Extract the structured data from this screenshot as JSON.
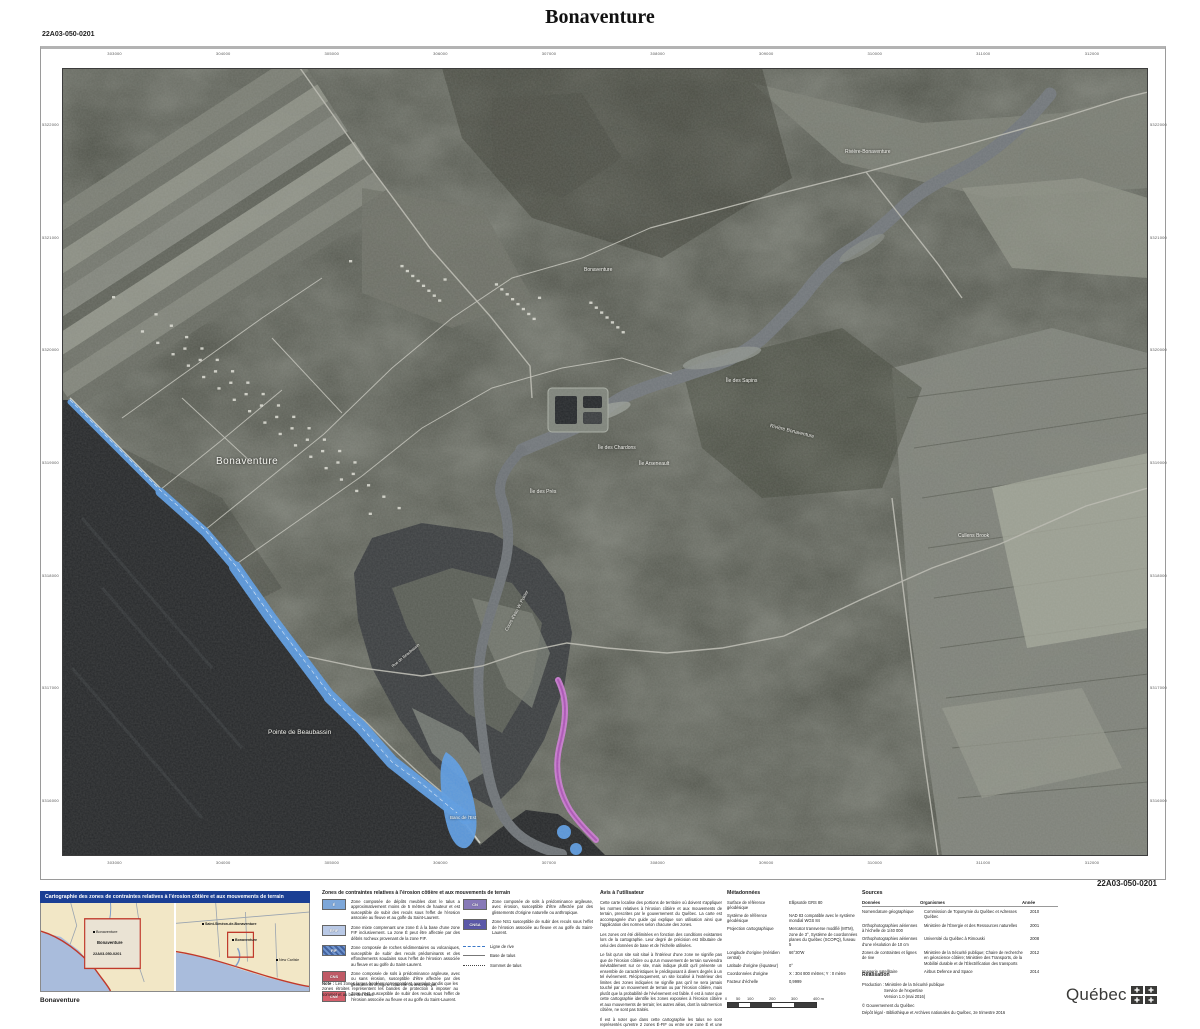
{
  "title": "Bonaventure",
  "sheet_code": "22A03-050-0201",
  "map": {
    "ticks_top": [
      "303000",
      "304000",
      "305000",
      "306000",
      "307000",
      "308000",
      "309000",
      "310000",
      "311000",
      "312000"
    ],
    "ticks_bottom": [
      "303000",
      "304000",
      "305000",
      "306000",
      "307000",
      "308000",
      "309000",
      "310000",
      "311000",
      "312000"
    ],
    "ticks_left": [
      "5322000",
      "5321000",
      "5320000",
      "5319000",
      "5318000",
      "5317000",
      "5316000"
    ],
    "ticks_right": [
      "5322000",
      "5321000",
      "5320000",
      "5319000",
      "5318000",
      "5317000",
      "5316000"
    ],
    "labels": [
      {
        "text": "Rivière-Bonaventure",
        "x": 783,
        "y": 81,
        "size": 5
      },
      {
        "text": "Bonaventure",
        "x": 522,
        "y": 199,
        "size": 5
      },
      {
        "text": "Île des Sapins",
        "x": 664,
        "y": 310,
        "size": 5
      },
      {
        "text": "Rivière Bonaventure",
        "x": 708,
        "y": 355,
        "size": 5,
        "rot": 14
      },
      {
        "text": "Île des Chardons",
        "x": 536,
        "y": 377,
        "size": 5
      },
      {
        "text": "Île Arseneault",
        "x": 577,
        "y": 393,
        "size": 5
      },
      {
        "text": "Île des Prés",
        "x": 468,
        "y": 421,
        "size": 5
      },
      {
        "text": "Bonaventure",
        "x": 154,
        "y": 388,
        "size": 10,
        "spacing": 0.5
      },
      {
        "text": "Cullens Brook",
        "x": 896,
        "y": 465,
        "size": 5
      },
      {
        "text": "Cours d'eau W. Poirier",
        "x": 444,
        "y": 560,
        "size": 4.5,
        "rot": -62
      },
      {
        "text": "Rue de Beaubassin",
        "x": 330,
        "y": 596,
        "size": 4,
        "rot": -40
      },
      {
        "text": "Pointe de Beaubassin",
        "x": 206,
        "y": 661,
        "size": 6.5
      },
      {
        "text": "Banc de l'Est",
        "x": 388,
        "y": 747,
        "size": 4.5
      }
    ]
  },
  "inset": {
    "title": "Cartographie des zones de contraintes relatives à l'érosion côtière et aux mouvements de terrain",
    "caption": "Bonaventure",
    "left_panel": {
      "labels": [
        {
          "text": "Bonaventure",
          "x": 52,
          "y": 28,
          "size": 3.8,
          "dot": true
        },
        {
          "text": "Bonaventure",
          "x": 56,
          "y": 38,
          "size": 4.2,
          "bold": true
        },
        {
          "text": "22A03-050-0201",
          "x": 52,
          "y": 50,
          "size": 3.8,
          "bold": true
        }
      ]
    },
    "right_panel": {
      "labels": [
        {
          "text": "Saint-Siméon-de-Bonaventure",
          "x": 26,
          "y": 20,
          "size": 3.6,
          "bold": true,
          "dot": true
        },
        {
          "text": "Bonaventure",
          "x": 56,
          "y": 36,
          "size": 3.6,
          "bold": true,
          "dot": true
        },
        {
          "text": "New Carlisle",
          "x": 100,
          "y": 56,
          "size": 3.6,
          "dot": true
        }
      ]
    }
  },
  "legend": {
    "title": "Zones de contraintes relatives à l'érosion côtière et aux mouvements de terrain",
    "items": [
      {
        "code": "É",
        "color": "#7da7d9",
        "text": "Zone composée de dépôts meubles dont le talus a approximativement moins de 5 mètres de hauteur et est susceptible de subir des reculs sous l'effet de l'érosion associée au fleuve et au golfe du Saint-Laurent."
      },
      {
        "code": "ÉFIF",
        "color": "#b9c9e6",
        "text": "Zone mixte comprenant une zone É à la base d'une zone FIF inclusivement. La zone É peut être affectée par des débris rocheux provenant de la zone FIF."
      },
      {
        "code": "FIF",
        "color": "#6f94cf",
        "color2": "#44639e",
        "text": "Zone composée de roches sédimentaires ou volcaniques, susceptible de subir des reculs prédominants et des effondrements soudains sous l'effet de l'érosion associée au fleuve et au golfe du Saint-Laurent."
      },
      {
        "code": "CNS",
        "color": "#c05a66",
        "text": "Zone composée de sols à prédominance argileuse, avec ou sans érosion, susceptible d'être affectée par des glissements d'origine naturelle ou anthropique."
      },
      {
        "code": "CNE",
        "color": "#d4606c",
        "text": "Zone NH1 susceptible de subir des reculs sous l'effet de l'érosion associée au fleuve et au golfe du Saint-Laurent."
      },
      {
        "code": "CN",
        "color": "#8779b8",
        "text": "Zone composée de sols à prédominance argileuse, avec érosion, susceptible d'être affectée par des glissements d'origine naturelle ou anthropique."
      },
      {
        "code": "CNSA",
        "color": "#5b58a8",
        "text": "Zone NS1 susceptible de subir des reculs sous l'effet de l'érosion associée au fleuve et au golfe du Saint-Laurent."
      }
    ],
    "lines": [
      {
        "label": "Ligne de rive",
        "style": "rive"
      },
      {
        "label": "Base de talus",
        "style": "base"
      },
      {
        "label": "Sommet de talus",
        "style": "sommet"
      }
    ],
    "note_label": "Note :",
    "note": "Les zones larges bordées correspondent aux talus tandis que les zones étroites représentent les bandes de protection à imposer au sommet et au bas des talus."
  },
  "avis": {
    "title": "Avis à l'utilisateur",
    "paragraphs": [
      "Cette carte localise des portions de territoire où doivent s'appliquer les normes relatives à l'érosion côtière et aux mouvements de terrain, prescrites par le gouvernement du Québec. La carte est accompagnée d'un guide qui explique son utilisation ainsi que l'application des normes selon chacune des zones.",
      "Les zones ont été délimitées en fonction des conditions existantes lors de la cartographie. Leur degré de précision est tributaire de celui des données de base et de l'échelle utilisées.",
      "Le fait qu'un site soit situé à l'intérieur d'une zone ne signifie pas que de l'érosion côtière ou qu'un mouvement de terrain surviendra inévitablement sur ce site, mais indique plutôt qu'il présente un ensemble de caractéristiques le prédisposant à divers degrés à un tel événement. Réciproquement, un site localisé à l'extérieur des limites des zones indiquées ne signifie pas qu'il ne sera jamais touché par un mouvement de terrain ou par l'érosion côtière, mais plutôt que la probabilité de l'événement est faible. Il est à noter que cette cartographie identifie les zones exposées à l'érosion côtière et aux mouvements de terrain; les autres aléas, dont la submersion côtière, ne sont pas traités.",
      "Il est à noter que dans cette cartographie les talus ne sont représentés qu'entre 2 zones É-FIF ou entre une zone É et une zone NS1 ou NH1."
    ]
  },
  "metadata": {
    "title": "Métadonnées",
    "rows": [
      {
        "label": "Surface de référence géodésique",
        "value": "Ellipsoïde GRS 80"
      },
      {
        "label": "Système de référence géodésique",
        "value": "NAD 83 compatible avec le système mondial WGS 84"
      },
      {
        "label": "Projection cartographique",
        "value": "Mercator transverse modifié (MTM), zone de 3°, Système de coordonnées planes du Québec (SCOPQ), fuseau 5"
      },
      {
        "label": "Longitude d'origine (méridien central)",
        "value": "66°30'W"
      },
      {
        "label": "Latitude d'origine (équateur)",
        "value": "0°"
      },
      {
        "label": "Coordonnées d'origine",
        "value": "X : 304 800 mètres; Y : 0 mètre"
      },
      {
        "label": "Facteur d'échelle",
        "value": "0,9999"
      }
    ]
  },
  "scalebar": {
    "ticks": [
      "0",
      "50",
      "100",
      "200",
      "300",
      "400 m"
    ]
  },
  "sources": {
    "title": "Sources",
    "headers": [
      "Données",
      "Organismes",
      "Année"
    ],
    "rows": [
      {
        "data": "Nomenclature géographique",
        "org": "Commission de Toponymie du Québec et Adresses Québec",
        "year": "2010"
      },
      {
        "data": "Orthophotographies aériennes à l'échelle de 1/40 000",
        "org": "Ministère de l'Énergie et des Ressources naturelles",
        "year": "2001"
      },
      {
        "data": "Orthophotographies aériennes d'une résolution de 10 cm",
        "org": "Université du Québec à Rimouski",
        "year": "2008"
      },
      {
        "data": "Zones de contraintes et lignes de rive",
        "org": "Ministère de la Sécurité publique; Chaire de recherche en géoscience côtière; Ministère des Transports, de la Mobilité durable et de l'Électrification des transports",
        "year": "2012"
      },
      {
        "data": "Imagerie satellitaire",
        "org": "Airbus Defence and Space",
        "year": "2014"
      }
    ]
  },
  "realisation": {
    "title": "Réalisation",
    "lines": [
      "Production : Ministère de la Sécurité publique",
      "Service de l'expertise",
      "Version 1.0 (mai 2016)",
      "© Gouvernement du Québec",
      "Dépôt légal - Bibliothèque et Archives nationales du Québec, 2e trimestre 2016"
    ]
  },
  "logo": {
    "wordmark": "Québec"
  },
  "colors": {
    "zone_blue": "#5b9be2",
    "zone_magenta": "#cb7ad2",
    "inset_header_blue": "#1b3f94",
    "inset_land": "#f2e7c6",
    "inset_water": "#a9bcdc",
    "highlight_red": "#c0392b"
  }
}
